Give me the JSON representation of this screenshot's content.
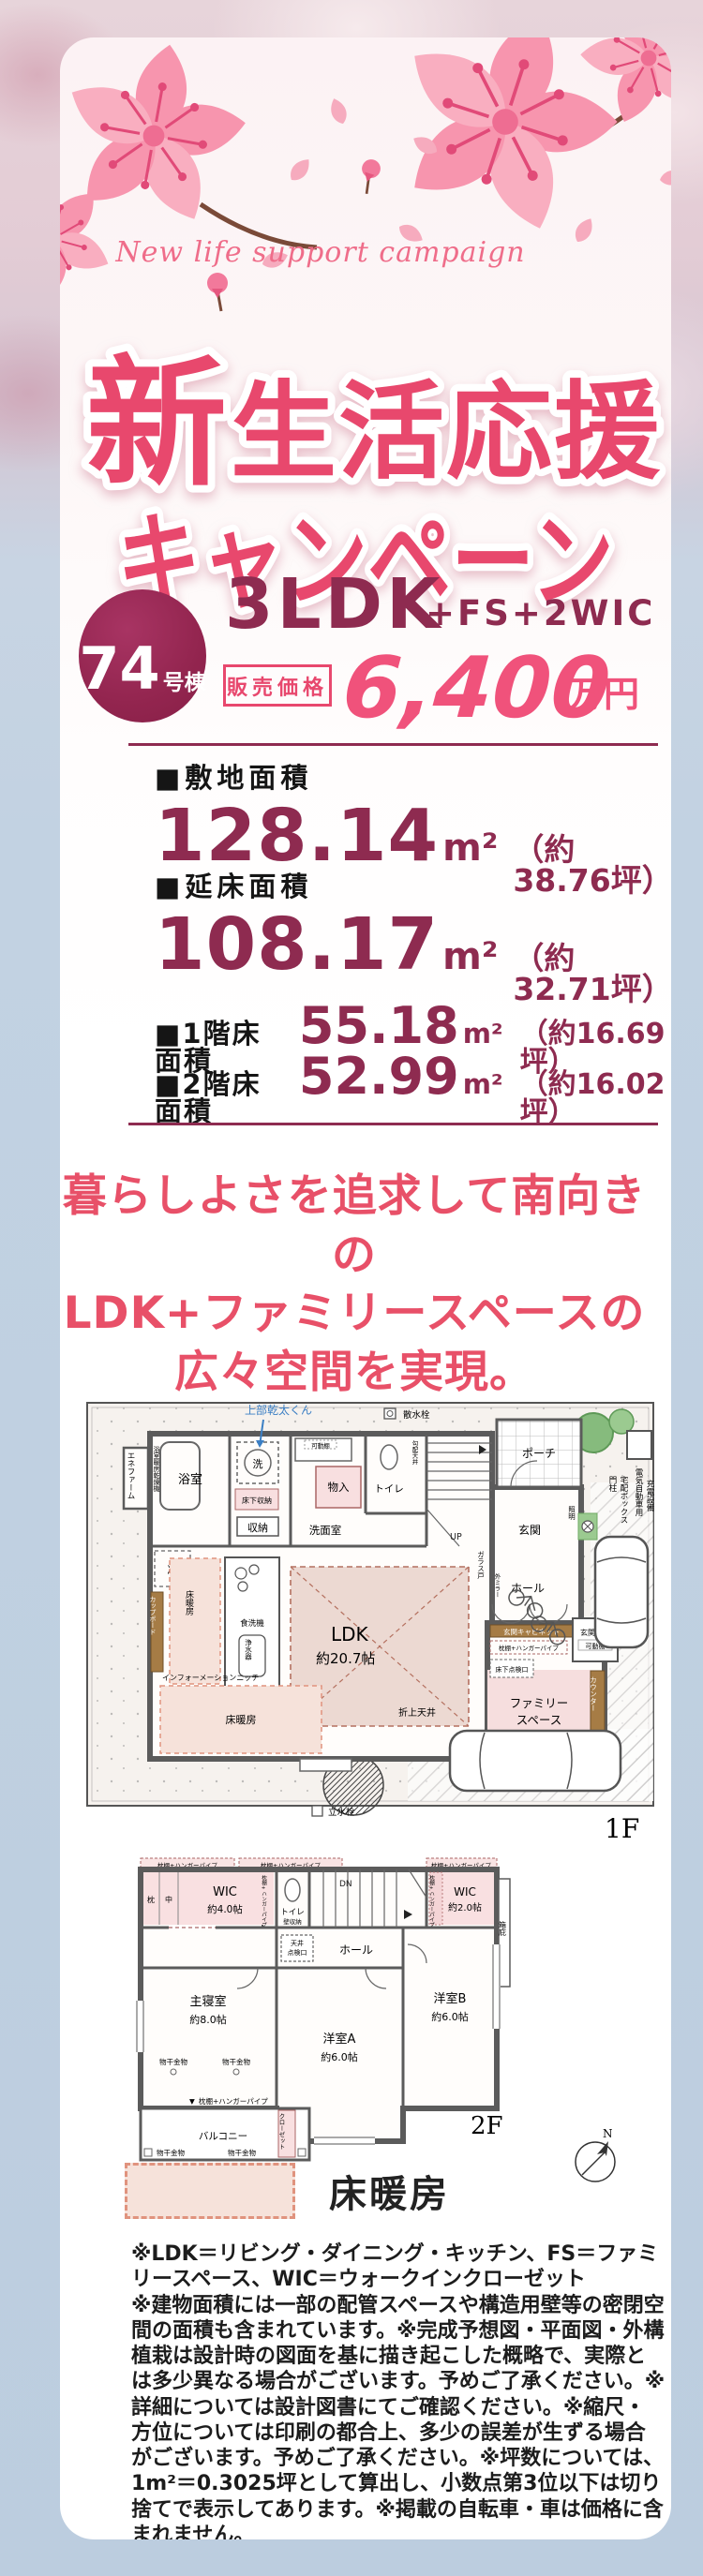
{
  "hero": {
    "script_text": "New life support campaign",
    "title_big": "新",
    "title_rest": "生活応援",
    "title_line2": "キャンペーン"
  },
  "offer": {
    "unit_number": "74",
    "unit_suffix": "号棟",
    "layout": "3LDK",
    "layout_extra": "+FS+2WIC",
    "price_label": "販売価格",
    "price_value": "6,400",
    "price_unit": "万円",
    "accent_color": "#e8486d",
    "maroon_color": "#8e2b50"
  },
  "areas": {
    "site_label": "■敷地面積",
    "site_value": "128.14",
    "site_unit": "m²",
    "site_tsubo": "（約38.76坪）",
    "total_label": "■延床面積",
    "total_value": "108.17",
    "total_unit": "m²",
    "total_tsubo": "（約32.71坪）",
    "f1_label": "■1階床面積",
    "f1_value": "55.18",
    "f1_unit": "m²",
    "f1_tsubo": "（約16.69坪）",
    "f2_label": "■2階床面積",
    "f2_value": "52.99",
    "f2_unit": "m²",
    "f2_tsubo": "（約16.02坪）"
  },
  "catchcopy": {
    "line1": "暮らしよさを追求して南向きの",
    "line2": "LDK+ファミリースペースの",
    "line3": "広々空間を実現。"
  },
  "plan1f": {
    "tag": "1F",
    "ene": "エネファーム",
    "bath_dryer": "浴室暖房乾燥機",
    "bath": "浴室",
    "washer": "洗",
    "kanta": "上部乾太くん",
    "underfloor_storage": "床下収納",
    "storage": "収納",
    "washroom": "洗面室",
    "movable_shelf": "可動棚",
    "closet_in": "物入",
    "toilet": "トイレ",
    "sloped_ceiling": "勾配天井",
    "up": "UP",
    "water_tap": "散水栓",
    "porch": "ポーチ",
    "entrance": "玄関",
    "light": "照明",
    "hall": "ホール",
    "glass_door": "ガラス戸",
    "mirror": "外ミラー",
    "entrance_cabinet": "玄関キャビネット",
    "entrance_storage": "玄関収納",
    "shelf_pipe": "枕棚+ハンガーパイプ",
    "underfloor_access": "床下点検口",
    "family1": "ファミリー",
    "family2": "スペース",
    "counter": "カウンター",
    "fridge": "冷",
    "cupboard": "カップボード",
    "floor_heating": "床暖房",
    "dishwasher": "食洗機",
    "purifier": "浄水器",
    "ldk": "LDK",
    "ldk_size": "約20.7帖",
    "coffered": "折上天井",
    "info_niche": "インフォーメーションニッチ",
    "standpipe": "立水栓",
    "gate_post": "門柱",
    "delivery_box": "宅配ボックス",
    "ev1": "電気自動車用",
    "ev2": "充電設備"
  },
  "plan2f": {
    "tag": "2F",
    "north": "N",
    "shelf_pipe": "枕棚+ハンガーパイプ",
    "pillow": "枕",
    "middle": "中",
    "wic": "WIC",
    "wic4_size": "約4.0帖",
    "wic2_size": "約2.0帖",
    "toilet": "トイレ",
    "wall_storage": "壁収納",
    "dn": "DN",
    "eave": "箱庇",
    "hall": "ホール",
    "ceiling1": "天井",
    "ceiling2": "点検口",
    "master": "主寝室",
    "master_size": "約8.0帖",
    "roomA": "洋室A",
    "roomA_size": "約6.0帖",
    "roomB": "洋室B",
    "roomB_size": "約6.0帖",
    "laundry": "物干金物",
    "closet": "クローゼット",
    "balcony": "バルコニー",
    "down_marker": "▼"
  },
  "legend": {
    "label": "床暖房"
  },
  "disclaimer": {
    "p1": "※LDK＝リビング・ダイニング・キッチン、FS＝ファミリースペース、WIC＝ウォークインクローゼット",
    "p2": "※建物面積には一部の配管スペースや構造用壁等の密閉空間の面積も含まれています。※完成予想図・平面図・外構植栽は設計時の図面を基に描き起こした概略で、実際とは多少異なる場合がございます。予めご了承ください。※詳細については設計図書にてご確認ください。※縮尺・方位については印刷の都合上、多少の誤差が生ずる場合がございます。予めご了承ください。※坪数については、1m²＝0.3025坪として算出し、小数点第3位以下は切り捨てで表示してあります。※掲載の自転車・車は価格に含まれません。"
  }
}
